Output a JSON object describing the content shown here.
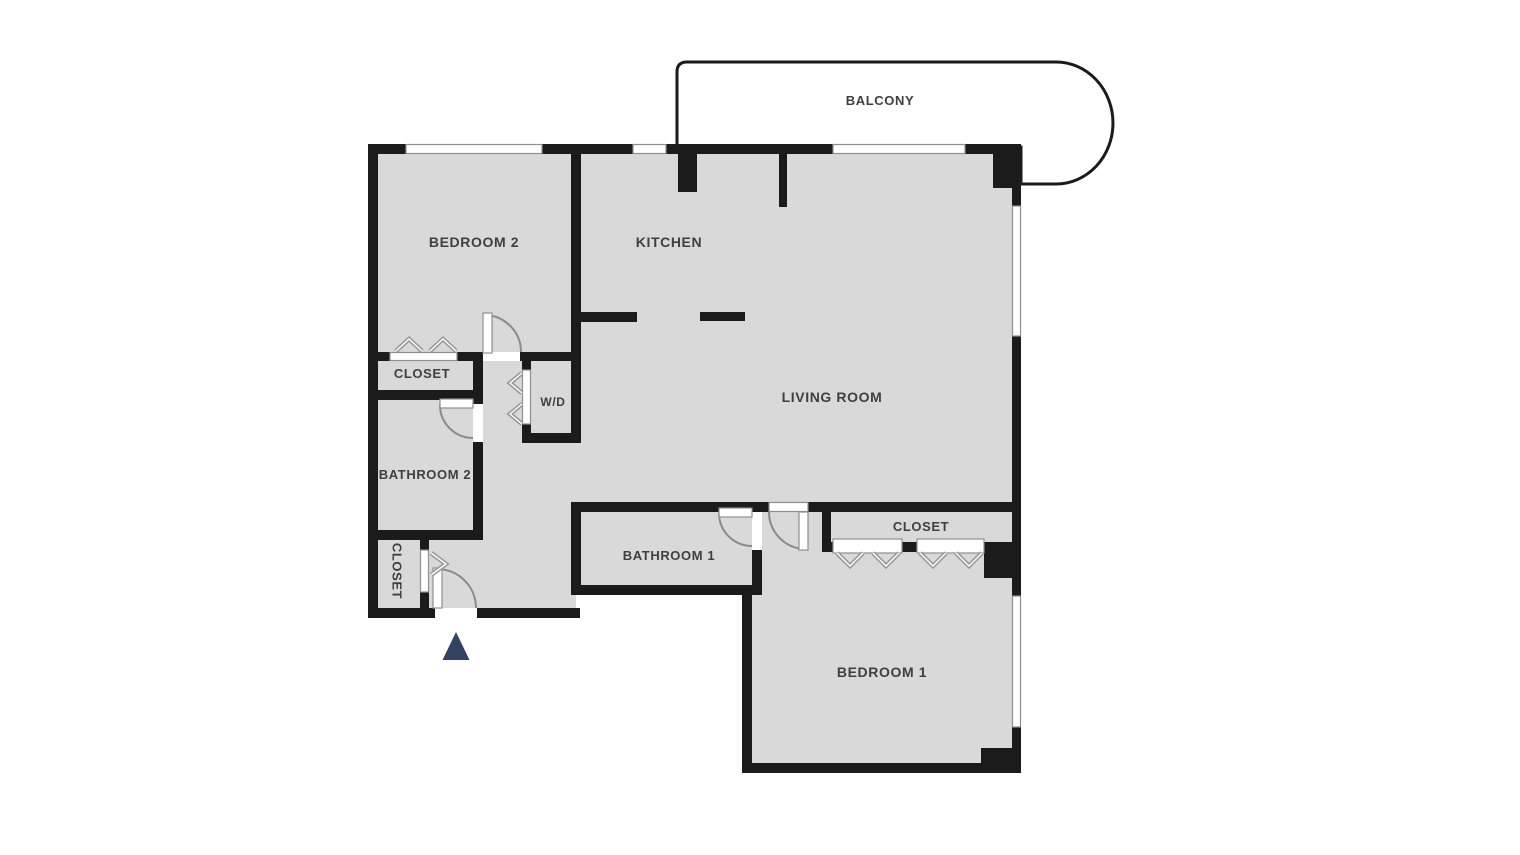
{
  "floorplan": {
    "rooms": {
      "balcony": {
        "label": "BALCONY"
      },
      "bedroom2": {
        "label": "BEDROOM 2"
      },
      "kitchen": {
        "label": "KITCHEN"
      },
      "living_room": {
        "label": "LIVING ROOM"
      },
      "closet_bedroom2": {
        "label": "CLOSET"
      },
      "wd": {
        "label": "W/D"
      },
      "bathroom2": {
        "label": "BATHROOM 2"
      },
      "closet_hall": {
        "label": "CLOSET"
      },
      "bathroom1": {
        "label": "BATHROOM 1"
      },
      "closet_bedroom1": {
        "label": "CLOSET"
      },
      "bedroom1": {
        "label": "BEDROOM 1"
      }
    },
    "icons": {
      "entry_marker": "triangle-up"
    },
    "colors": {
      "wall": "#1b1b1b",
      "floor": "#d9d9d9",
      "background": "#ffffff",
      "casing": "#8f8f8f",
      "door_arc": "#8a8a8a",
      "hanger_symbol": "#989898",
      "entry_marker": "#344160",
      "label_text": "#3f3f3f"
    }
  }
}
